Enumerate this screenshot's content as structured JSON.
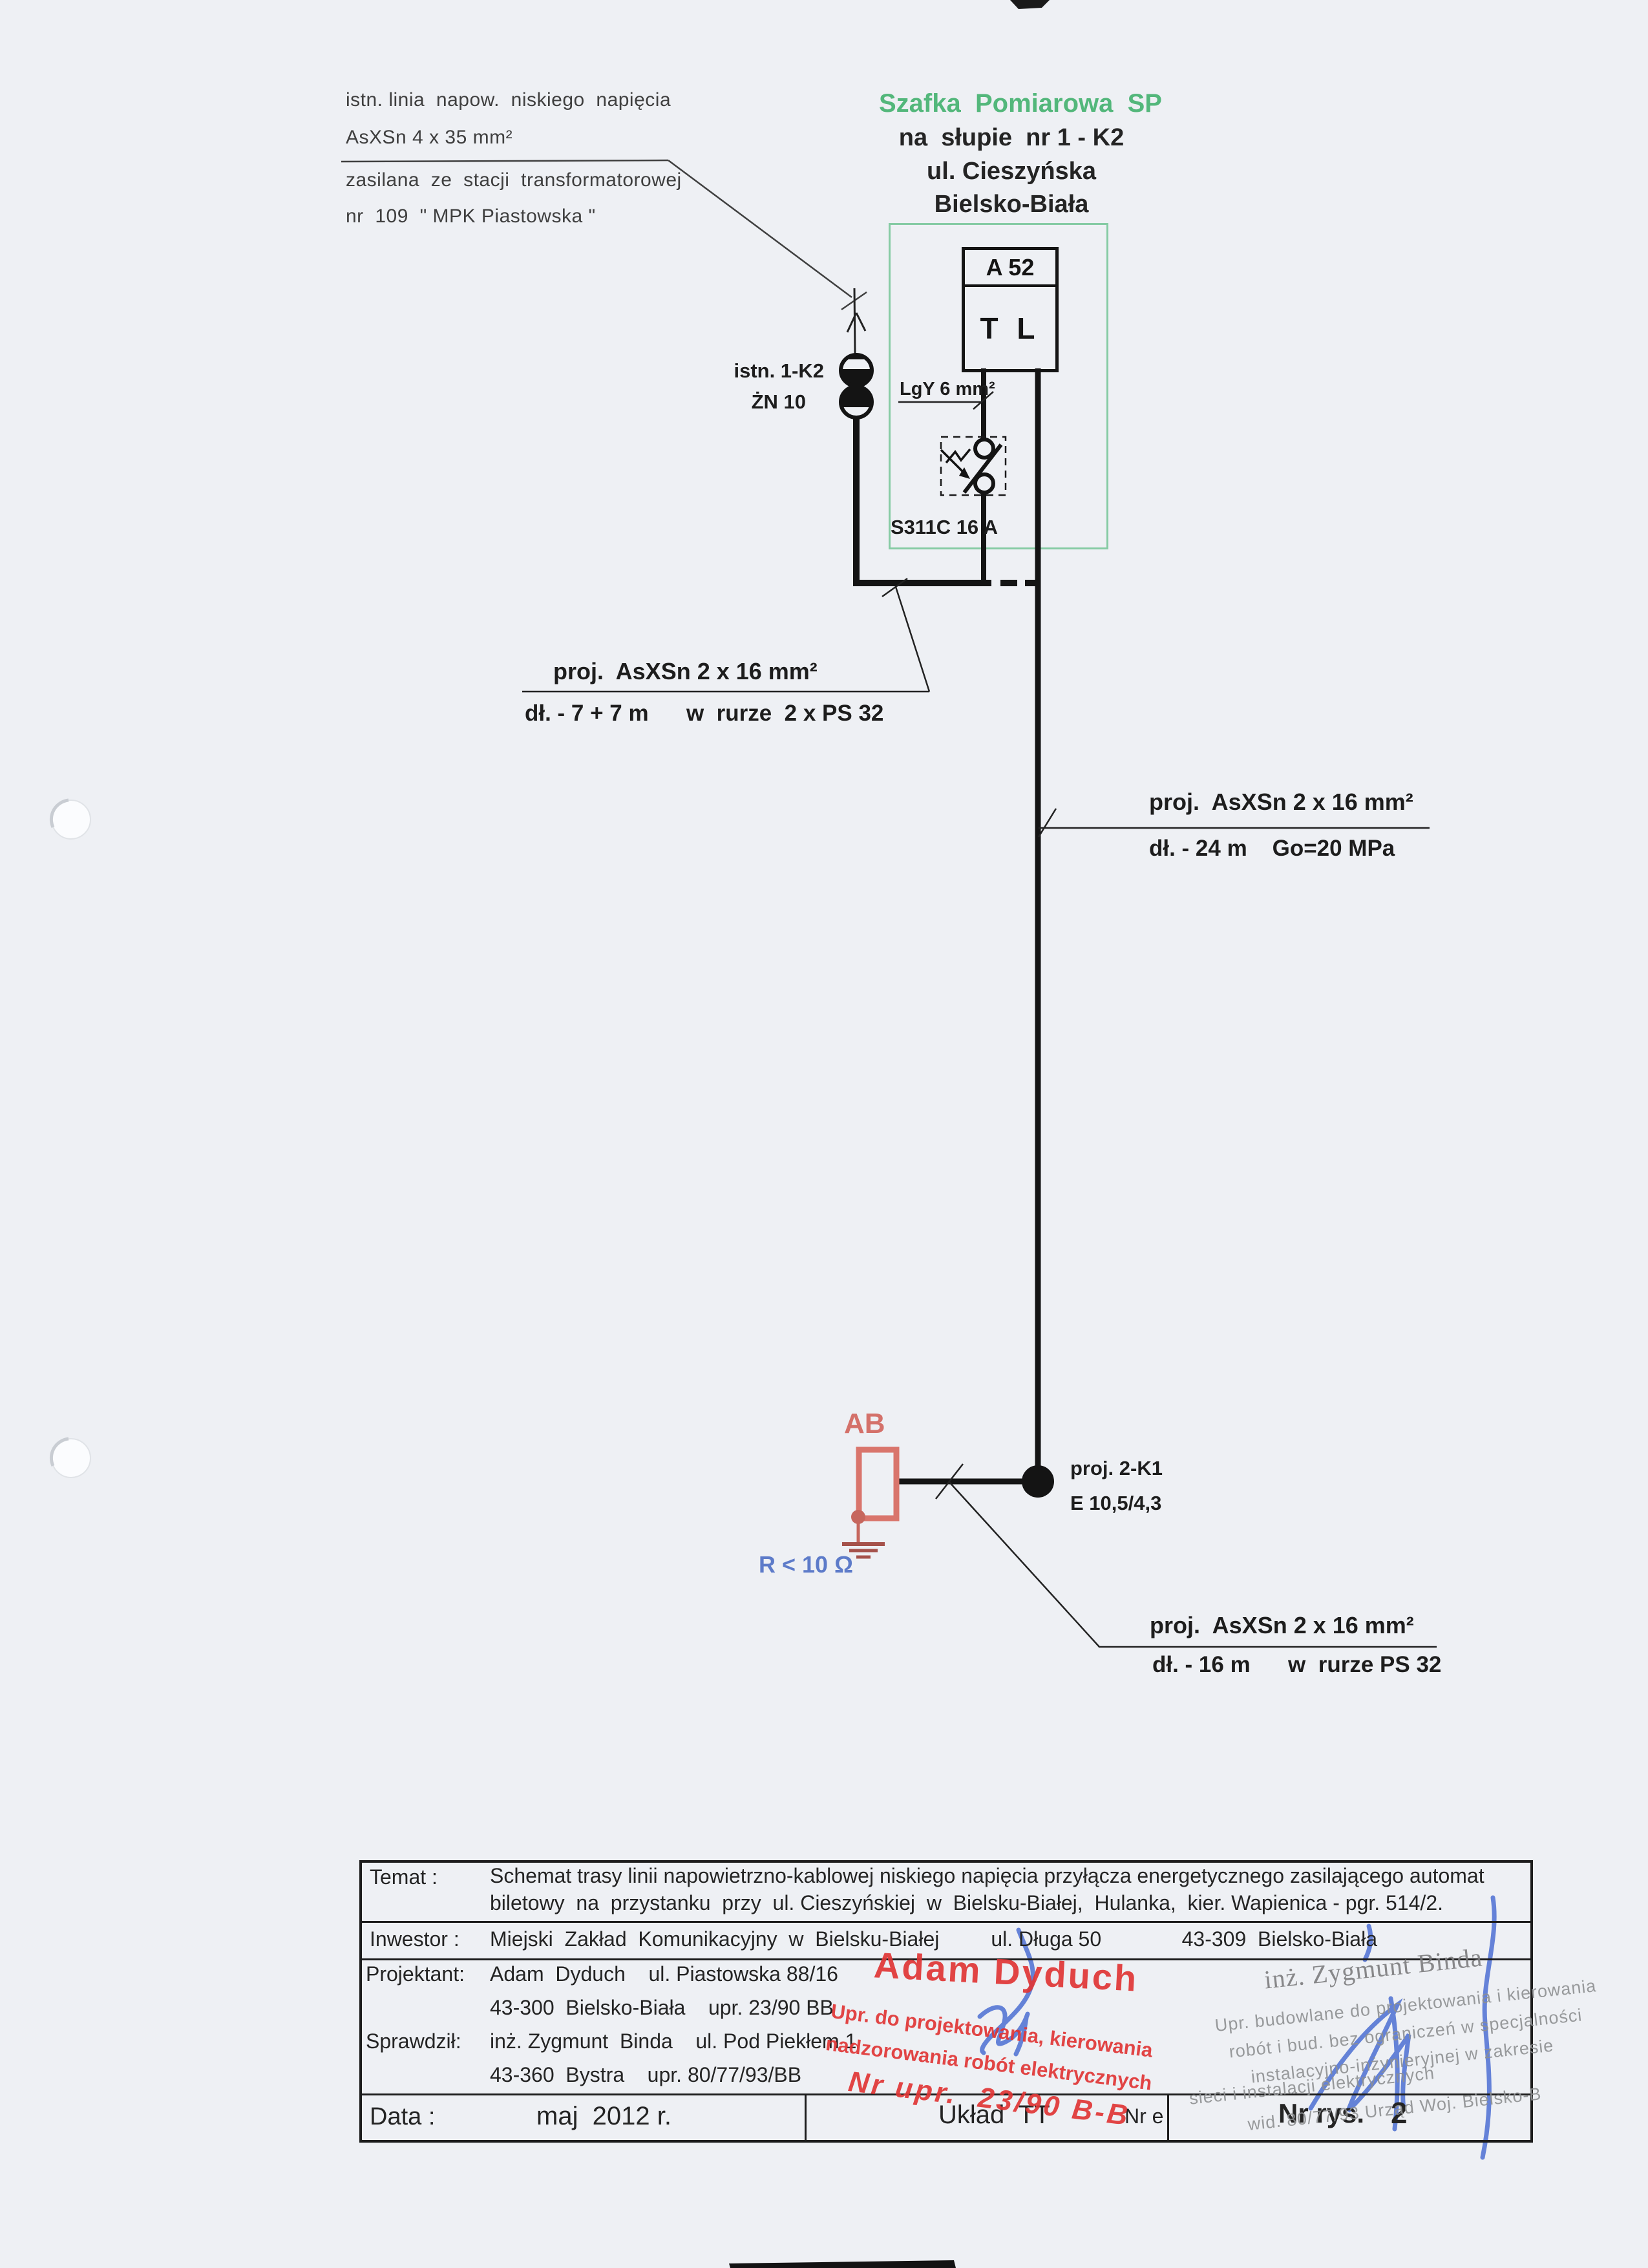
{
  "colors": {
    "paper": "#eef0f4",
    "line_black": "#141414",
    "green_title": "#53b77b",
    "green_box": "#86cba4",
    "red_diagram": "#d4716a",
    "blue_text": "#5d7bc9",
    "red_stamp": "#e03636",
    "gray_stamp": "#8e9092",
    "blue_pen": "#4c6fd2"
  },
  "top_note": {
    "line1": "istn. linia  napow.  niskiego  napięcia",
    "line2": "AsXSn 4 x 35 mm²",
    "line3": "zasilana  ze  stacji  transformatorowej",
    "line4": "nr  109  \" MPK Piastowska \""
  },
  "header": {
    "title": "Szafka  Pomiarowa  SP",
    "line2": "na  słupie  nr 1 - K2",
    "line3": "ul. Cieszyńska",
    "line4": "Bielsko-Biała"
  },
  "meter": {
    "id": "A 52",
    "type": "T L",
    "cable": "LgY 6 mm²",
    "breaker": "S311C 16 A"
  },
  "pole": {
    "label1": "istn. 1-K2",
    "label2": "ŻN 10"
  },
  "segments": {
    "seg1_line1": "proj.  AsXSn 2 x 16 mm²",
    "seg1_line2": "dł. - 7 + 7 m      w  rurze  2 x PS 32",
    "seg2_line1": "proj.  AsXSn 2 x 16 mm²",
    "seg2_line2": "dł. - 24 m    Go=20 MPa",
    "seg3_line1": "proj.  AsXSn 2 x 16 mm²",
    "seg3_line2": "dł. - 16 m      w  rurze PS 32"
  },
  "ticket_machine": {
    "label": "AB",
    "earth_resistance": "R < 10 Ω",
    "pole_label1": "proj. 2-K1",
    "pole_label2": "E 10,5/4,3"
  },
  "titleblock": {
    "temat_label": "Temat :",
    "temat_line1": "Schemat trasy linii napowietrzno-kablowej niskiego napięcia przyłącza energetycznego zasilającego automat",
    "temat_line2": "biletowy  na  przystanku  przy  ul. Cieszyńskiej  w  Bielsku-Białej,  Hulanka,  kier. Wapienica - pgr. 514/2.",
    "inwestor_label": "Inwestor :",
    "inwestor_value": "Miejski  Zakład  Komunikacyjny  w  Bielsku-Białej         ul. Długa 50              43-309  Bielsko-Biała",
    "projektant_label": "Projektant:",
    "projektant_line1": "Adam  Dyduch    ul. Piastowska 88/16",
    "projektant_line2": "43-300  Bielsko-Biała    upr. 23/90 BB",
    "sprawdzil_label": "Sprawdził:",
    "sprawdzil_line1": "inż. Zygmunt  Binda    ul. Pod Piekłem 1",
    "sprawdzil_line2": "43-360  Bystra    upr. 80/77/93/BB",
    "data_label": "Data :",
    "data_value": "maj  2012 r.",
    "uklad_value": "Układ  TT",
    "nr_ewid_label": "Nr e",
    "nr_rys_label": "Nr rys.",
    "nr_rys_value": "2"
  },
  "stamps": {
    "red_name": "Adam Dyduch",
    "red_line1": "Upr. do projektowania, kierowania",
    "red_line2": "nadzorowania robót elektrycznych",
    "red_line3": "Nr upr.  23/90 B-B",
    "gray_name": "inż. Zygmunt Binda",
    "gray_line1": "Upr. budowlane do projektowania i kierowania",
    "gray_line2": "robót i bud. bez ograniczeń w specjalności",
    "gray_line3": "instalacyjno-inżynieryjnej w zakresie",
    "gray_line4": "sieci i instalacji elektrycznych",
    "gray_line5": "wid. 80/77/93 Urząd Woj. Bielsko-B"
  }
}
